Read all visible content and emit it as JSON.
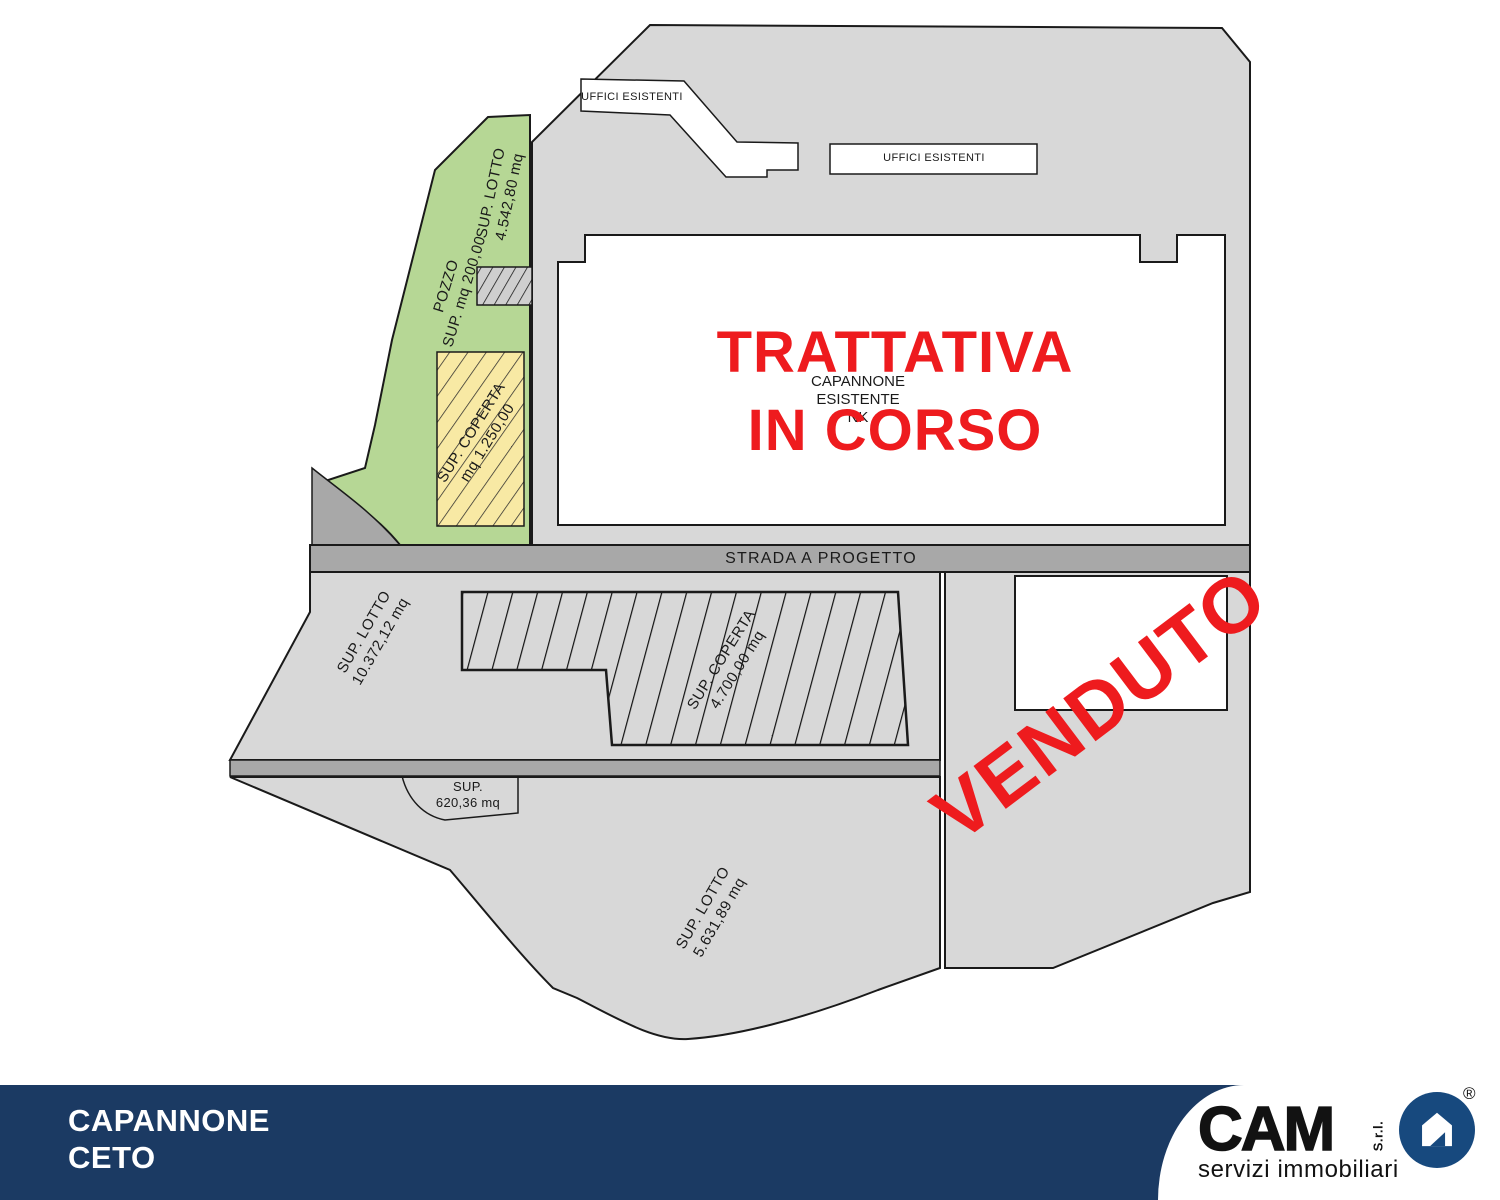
{
  "plan": {
    "offices_left": "UFFICI ESISTENTI",
    "offices_right": "UFFICI ESISTENTI",
    "green_lot": {
      "title": "SUP. LOTTO",
      "value": "4.542,80 mq"
    },
    "well": {
      "title": "POZZO",
      "value": "SUP. mq 200,00"
    },
    "green_covered": {
      "title": "SUP. COPERTA",
      "value": "mq 1.250,00"
    },
    "existing_building": {
      "line1": "CAPANNONE",
      "line2": "ESISTENTE",
      "line3": "NK"
    },
    "status_negotiation": {
      "line1": "TRATTATIVA",
      "line2": "IN CORSO"
    },
    "road": "STRADA A PROGETTO",
    "mid_lot": {
      "title": "SUP. LOTTO",
      "value": "10.372,12 mq"
    },
    "mid_covered": {
      "title": "SUP. COPERTA",
      "value": "4.700,00 mq"
    },
    "small_lot": {
      "title": "SUP.",
      "value": "620,36 mq"
    },
    "bottom_lot": {
      "title": "SUP. LOTTO",
      "value": "5.631,89 mq"
    },
    "status_sold": "VENDUTO"
  },
  "footer": {
    "title_line1": "CAPANNONE",
    "title_line2": "CETO",
    "logo": {
      "name": "CAM",
      "srl": "S.r.l.",
      "registered": "®",
      "tagline": "servizi immobiliari"
    }
  },
  "colors": {
    "status_red": "#ee1b1e",
    "footer_navy": "#1b3a63",
    "lot_green": "#b6d795",
    "covered_yellow": "#f8e9a4",
    "parcel_gray": "#d8d8d8",
    "road_gray": "#a8a8a8",
    "logo_blue": "#17497e"
  }
}
